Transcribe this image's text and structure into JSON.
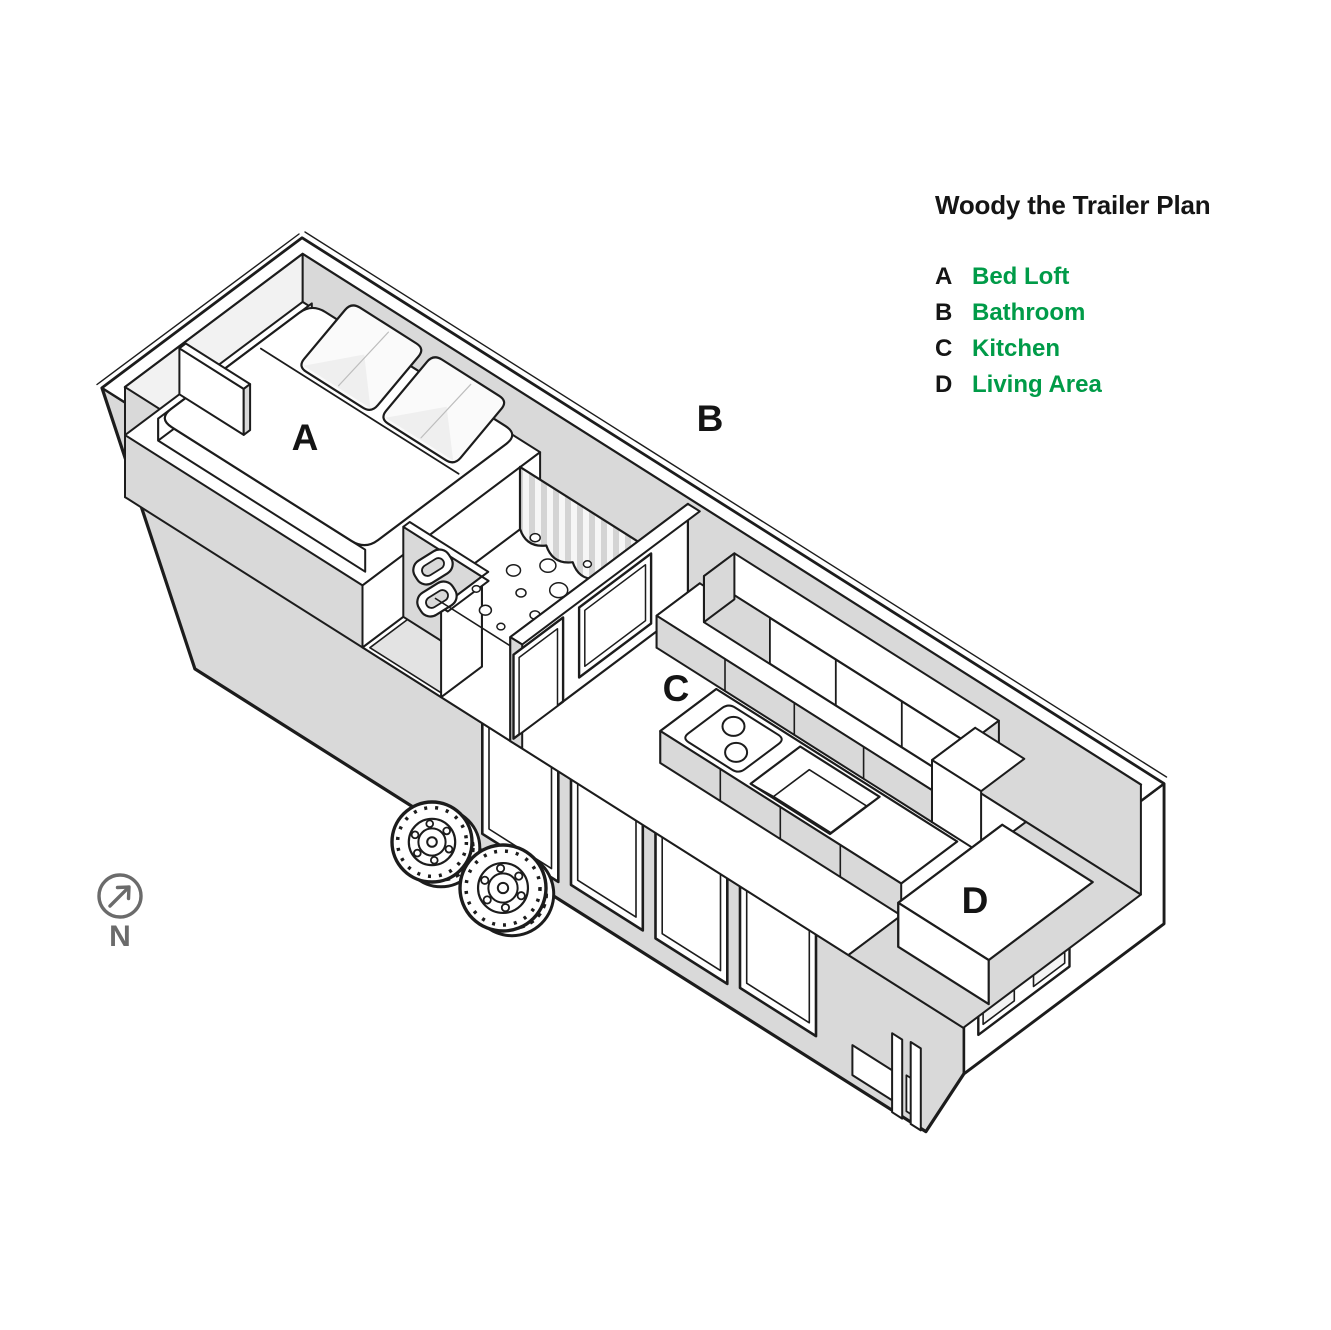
{
  "title": "Woody the Trailer Plan",
  "legend": [
    {
      "letter": "A",
      "label": "Bed Loft"
    },
    {
      "letter": "B",
      "label": "Bathroom"
    },
    {
      "letter": "C",
      "label": "Kitchen"
    },
    {
      "letter": "D",
      "label": "Living Area"
    }
  ],
  "plan_labels": [
    {
      "letter": "A"
    },
    {
      "letter": "B"
    },
    {
      "letter": "C"
    },
    {
      "letter": "D"
    }
  ],
  "compass": {
    "label": "N"
  },
  "colors": {
    "accent_green": "#009B48",
    "ink": "#1c1c1c",
    "wall_gray": "#d9d9d9",
    "light_gray": "#f2f2f2",
    "muted_gray": "#6b6b6b",
    "background": "#ffffff"
  }
}
